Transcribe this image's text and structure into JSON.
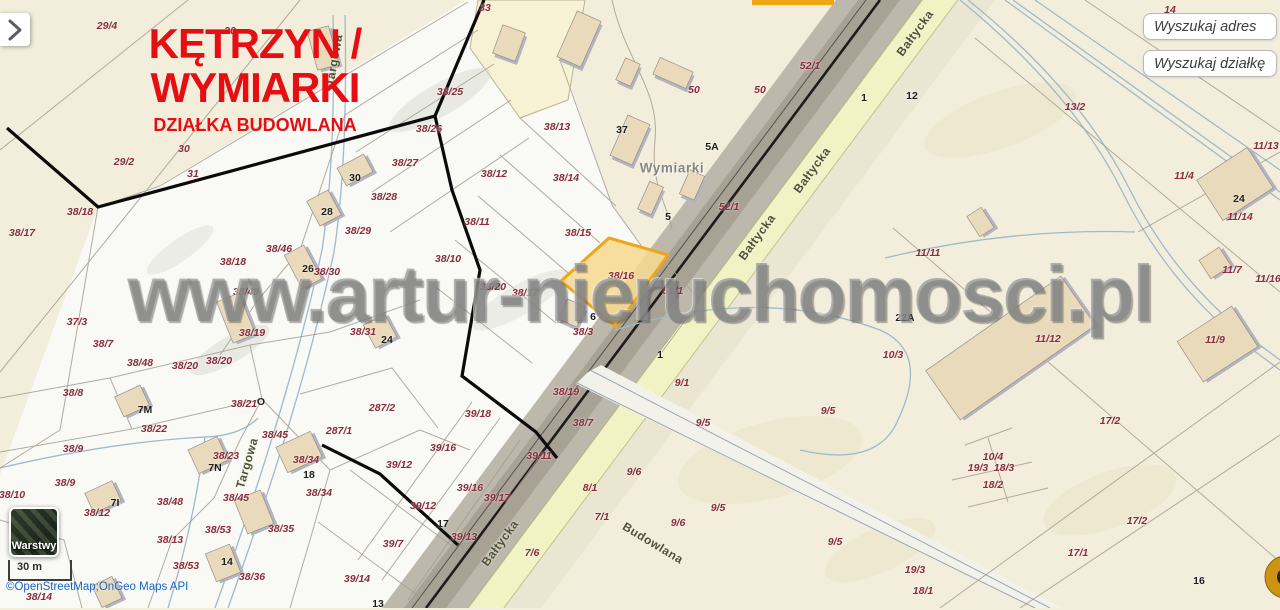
{
  "header": {
    "title": "KĘTRZYN / WYMIARKI",
    "subtitle": "DZIAŁKA BUDOWLANA"
  },
  "search": {
    "address_placeholder": "Wyszukaj adres",
    "parcel_placeholder": "Wyszukaj działkę"
  },
  "controls": {
    "layers_label": "Warstwy",
    "scale_label": "30 m",
    "attribution": "©OpenStreetMap;OnGeo Maps API"
  },
  "watermark": "www.artur-nieruchomosci.pl",
  "colors": {
    "accent_red": "#e60e12",
    "highlight_fill": "#f7d98e",
    "highlight_stroke": "#eca61b",
    "attribution_blue": "#1565c0",
    "parcel_label": "#8a2c3b"
  },
  "map": {
    "highlighted_parcel": "38/16",
    "place_label": {
      "t": "Wymiarki",
      "x": 672,
      "y": 168
    },
    "street_labels": [
      {
        "t": "Bałtycka",
        "x": 915,
        "y": 33,
        "rot": -54
      },
      {
        "t": "Bałtycka",
        "x": 812,
        "y": 170,
        "rot": -54
      },
      {
        "t": "Bałtycka",
        "x": 757,
        "y": 237,
        "rot": -54
      },
      {
        "t": "Bałtycka",
        "x": 500,
        "y": 543,
        "rot": -54
      },
      {
        "t": "Budowlana",
        "x": 653,
        "y": 543,
        "rot": 31
      },
      {
        "t": "Targowa",
        "x": 247,
        "y": 463,
        "rot": -74
      },
      {
        "t": "Targowa",
        "x": 334,
        "y": 60,
        "rot": -80
      }
    ],
    "building_labels": [
      {
        "t": "30",
        "x": 355,
        "y": 178
      },
      {
        "t": "28",
        "x": 327,
        "y": 212
      },
      {
        "t": "26",
        "x": 308,
        "y": 269
      },
      {
        "t": "24",
        "x": 387,
        "y": 340
      },
      {
        "t": "37",
        "x": 622,
        "y": 130
      },
      {
        "t": "5A",
        "x": 712,
        "y": 147
      },
      {
        "t": "5",
        "x": 668,
        "y": 217
      },
      {
        "t": "6",
        "x": 593,
        "y": 317
      },
      {
        "t": "1",
        "x": 864,
        "y": 98
      },
      {
        "t": "1",
        "x": 660,
        "y": 355
      },
      {
        "t": "12",
        "x": 912,
        "y": 96
      },
      {
        "t": "22A",
        "x": 905,
        "y": 318
      },
      {
        "t": "24",
        "x": 1239,
        "y": 199
      },
      {
        "t": "7M",
        "x": 145,
        "y": 410
      },
      {
        "t": "7N",
        "x": 215,
        "y": 468
      },
      {
        "t": "7I",
        "x": 115,
        "y": 503
      },
      {
        "t": "18",
        "x": 309,
        "y": 475
      },
      {
        "t": "17",
        "x": 443,
        "y": 524
      },
      {
        "t": "14",
        "x": 227,
        "y": 562
      },
      {
        "t": "13",
        "x": 378,
        "y": 604
      },
      {
        "t": "16",
        "x": 1199,
        "y": 581
      },
      {
        "t": "O",
        "x": 261,
        "y": 402
      }
    ],
    "parcel_labels": [
      {
        "t": "29/4",
        "x": 107,
        "y": 26
      },
      {
        "t": "33",
        "x": 485,
        "y": 8
      },
      {
        "t": "14",
        "x": 1170,
        "y": 10
      },
      {
        "t": "30",
        "x": 230,
        "y": 31
      },
      {
        "t": "38/25",
        "x": 450,
        "y": 92
      },
      {
        "t": "52/1",
        "x": 810,
        "y": 66
      },
      {
        "t": "50",
        "x": 694,
        "y": 90
      },
      {
        "t": "50",
        "x": 760,
        "y": 90
      },
      {
        "t": "29/2",
        "x": 124,
        "y": 162
      },
      {
        "t": "30",
        "x": 184,
        "y": 149
      },
      {
        "t": "31",
        "x": 193,
        "y": 174
      },
      {
        "t": "38/26",
        "x": 429,
        "y": 129
      },
      {
        "t": "38/13",
        "x": 557,
        "y": 127
      },
      {
        "t": "38/14",
        "x": 566,
        "y": 178
      },
      {
        "t": "13/2",
        "x": 1075,
        "y": 107
      },
      {
        "t": "38/27",
        "x": 405,
        "y": 163
      },
      {
        "t": "38/28",
        "x": 384,
        "y": 197
      },
      {
        "t": "38/12",
        "x": 494,
        "y": 174
      },
      {
        "t": "38/29",
        "x": 358,
        "y": 231
      },
      {
        "t": "38/11",
        "x": 477,
        "y": 222
      },
      {
        "t": "38/15",
        "x": 578,
        "y": 233
      },
      {
        "t": "11/13",
        "x": 1266,
        "y": 146
      },
      {
        "t": "11/4",
        "x": 1184,
        "y": 176
      },
      {
        "t": "38/17",
        "x": 22,
        "y": 233
      },
      {
        "t": "38/18",
        "x": 80,
        "y": 212
      },
      {
        "t": "38/46",
        "x": 279,
        "y": 249
      },
      {
        "t": "38/30",
        "x": 327,
        "y": 272
      },
      {
        "t": "38/10",
        "x": 448,
        "y": 259
      },
      {
        "t": "38/16",
        "x": 621,
        "y": 276
      },
      {
        "t": "52/1",
        "x": 729,
        "y": 207
      },
      {
        "t": "11/14",
        "x": 1240,
        "y": 217
      },
      {
        "t": "11/7",
        "x": 1232,
        "y": 270
      },
      {
        "t": "11/16",
        "x": 1268,
        "y": 279
      },
      {
        "t": "11/11",
        "x": 928,
        "y": 253
      },
      {
        "t": "38/18",
        "x": 233,
        "y": 262
      },
      {
        "t": "38/49",
        "x": 246,
        "y": 292
      },
      {
        "t": "51/1",
        "x": 673,
        "y": 291
      },
      {
        "t": "38/20",
        "x": 493,
        "y": 287
      },
      {
        "t": "38/17",
        "x": 525,
        "y": 293
      },
      {
        "t": "38/3",
        "x": 583,
        "y": 332
      },
      {
        "t": "37/3",
        "x": 77,
        "y": 322
      },
      {
        "t": "38/19",
        "x": 252,
        "y": 333
      },
      {
        "t": "38/31",
        "x": 363,
        "y": 332
      },
      {
        "t": "11/12",
        "x": 1048,
        "y": 339
      },
      {
        "t": "10/3",
        "x": 893,
        "y": 355
      },
      {
        "t": "11/9",
        "x": 1215,
        "y": 340
      },
      {
        "t": "38/7",
        "x": 103,
        "y": 344
      },
      {
        "t": "38/48",
        "x": 140,
        "y": 363
      },
      {
        "t": "38/20",
        "x": 185,
        "y": 366
      },
      {
        "t": "38/20",
        "x": 219,
        "y": 361
      },
      {
        "t": "38/8",
        "x": 73,
        "y": 393
      },
      {
        "t": "287/2",
        "x": 382,
        "y": 408
      },
      {
        "t": "39/18",
        "x": 478,
        "y": 414
      },
      {
        "t": "38/21",
        "x": 244,
        "y": 404
      },
      {
        "t": "38/22",
        "x": 154,
        "y": 429
      },
      {
        "t": "9/1",
        "x": 682,
        "y": 383
      },
      {
        "t": "38/7",
        "x": 583,
        "y": 423
      },
      {
        "t": "38/19",
        "x": 566,
        "y": 392
      },
      {
        "t": "9/5",
        "x": 703,
        "y": 423
      },
      {
        "t": "9/5",
        "x": 828,
        "y": 411
      },
      {
        "t": "38/9",
        "x": 73,
        "y": 449
      },
      {
        "t": "38/23",
        "x": 226,
        "y": 456
      },
      {
        "t": "38/45",
        "x": 275,
        "y": 435
      },
      {
        "t": "287/1",
        "x": 339,
        "y": 431
      },
      {
        "t": "38/34",
        "x": 306,
        "y": 460
      },
      {
        "t": "39/16",
        "x": 443,
        "y": 448
      },
      {
        "t": "39/12",
        "x": 399,
        "y": 465
      },
      {
        "t": "39/11",
        "x": 539,
        "y": 456
      },
      {
        "t": "17/2",
        "x": 1110,
        "y": 421
      },
      {
        "t": "38/34",
        "x": 319,
        "y": 493
      },
      {
        "t": "39/16",
        "x": 470,
        "y": 488
      },
      {
        "t": "39/17",
        "x": 497,
        "y": 498
      },
      {
        "t": "39/12",
        "x": 423,
        "y": 506
      },
      {
        "t": "38/9",
        "x": 65,
        "y": 483
      },
      {
        "t": "38/10",
        "x": 12,
        "y": 495
      },
      {
        "t": "38/48",
        "x": 170,
        "y": 502
      },
      {
        "t": "38/12",
        "x": 97,
        "y": 513
      },
      {
        "t": "38/45",
        "x": 236,
        "y": 498
      },
      {
        "t": "9/6",
        "x": 634,
        "y": 472
      },
      {
        "t": "8/1",
        "x": 590,
        "y": 488
      },
      {
        "t": "10/4",
        "x": 993,
        "y": 457
      },
      {
        "t": "19/3",
        "x": 978,
        "y": 468
      },
      {
        "t": "18/3",
        "x": 1004,
        "y": 468
      },
      {
        "t": "18/2",
        "x": 993,
        "y": 485
      },
      {
        "t": "7/1",
        "x": 602,
        "y": 517
      },
      {
        "t": "9/6",
        "x": 678,
        "y": 523
      },
      {
        "t": "9/5",
        "x": 718,
        "y": 508
      },
      {
        "t": "39/13",
        "x": 464,
        "y": 537
      },
      {
        "t": "39/7",
        "x": 393,
        "y": 544
      },
      {
        "t": "38/53",
        "x": 218,
        "y": 530
      },
      {
        "t": "38/13",
        "x": 170,
        "y": 540
      },
      {
        "t": "38/35",
        "x": 281,
        "y": 529
      },
      {
        "t": "7/6",
        "x": 532,
        "y": 553
      },
      {
        "t": "9/5",
        "x": 835,
        "y": 542
      },
      {
        "t": "17/2",
        "x": 1137,
        "y": 521
      },
      {
        "t": "17/1",
        "x": 1078,
        "y": 553
      },
      {
        "t": "38/53",
        "x": 186,
        "y": 566
      },
      {
        "t": "38/36",
        "x": 252,
        "y": 577
      },
      {
        "t": "39/14",
        "x": 357,
        "y": 579
      },
      {
        "t": "19/3",
        "x": 915,
        "y": 570
      },
      {
        "t": "18/1",
        "x": 923,
        "y": 591
      },
      {
        "t": "38/14",
        "x": 39,
        "y": 597
      }
    ]
  }
}
